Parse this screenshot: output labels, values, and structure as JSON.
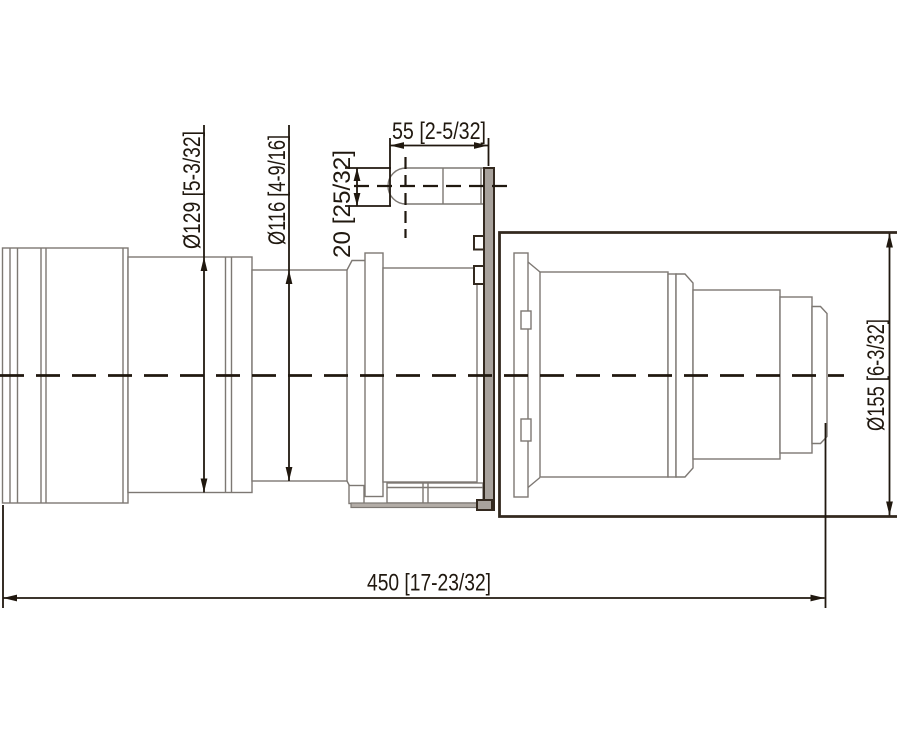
{
  "colors": {
    "dim": "#20180f",
    "body": "#7d7873",
    "bold": "#33291f",
    "plate_fill": "#a8a29c",
    "strip_fill": "#b3ada7"
  },
  "dimensions": [
    {
      "id": "rear-barrel-diameter",
      "mm": 129,
      "inches": "5-3/32",
      "label": "Ø129 [5-3/32]"
    },
    {
      "id": "mid-barrel-diameter",
      "mm": 116,
      "inches": "4-9/16",
      "label": "Ø116 [4-9/16]"
    },
    {
      "id": "pin-length",
      "mm": 55,
      "inches": "2-5/32",
      "label": "55 [2-5/32]"
    },
    {
      "id": "pin-diameter",
      "mm": 20,
      "inches": "25/32",
      "label": "20 [25/32]"
    },
    {
      "id": "front-housing-diameter",
      "mm": 155,
      "inches": "6-3/32",
      "label": "Ø155 [6-3/32]"
    },
    {
      "id": "overall-length",
      "mm": 450,
      "inches": "17-23/32",
      "label": "450 [17-23/32]"
    }
  ]
}
